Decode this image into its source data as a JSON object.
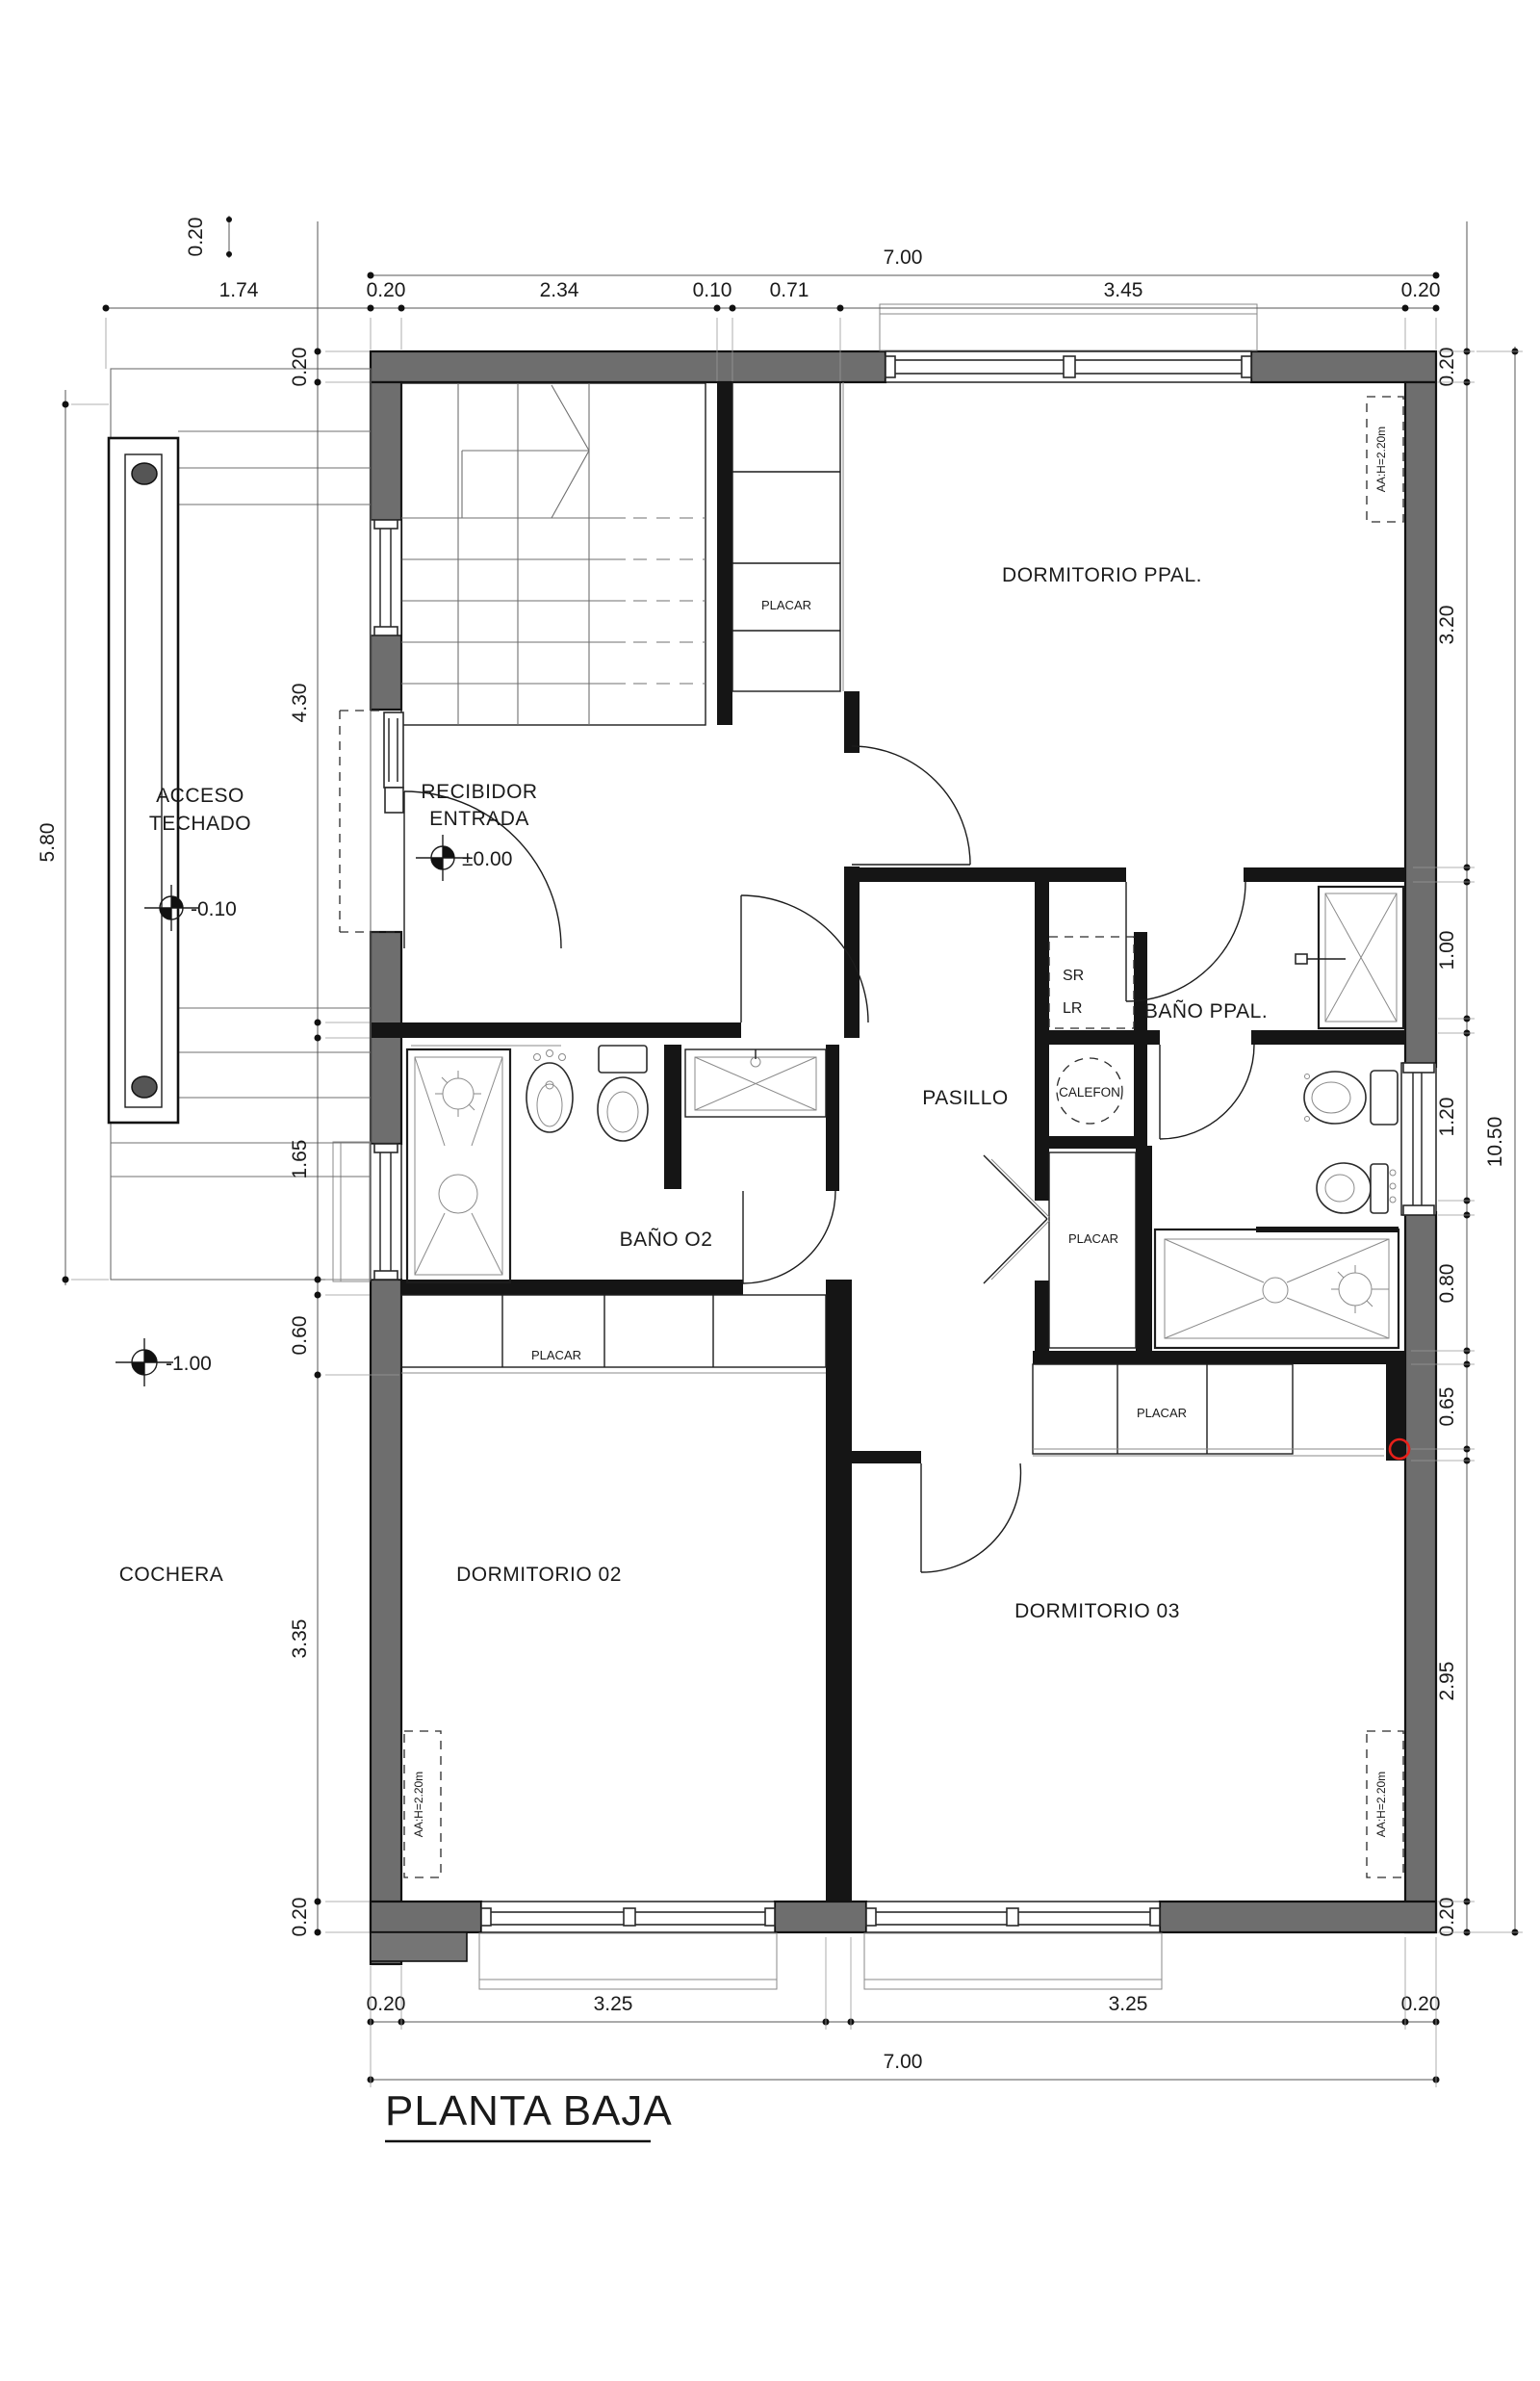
{
  "title": {
    "text": "PLANTA BAJA"
  },
  "rooms": {
    "acceso": {
      "line1": "ACCESO",
      "line2": "TECHADO",
      "level": "-0.10"
    },
    "recibidor": {
      "line1": "RECIBIDOR",
      "line2": "ENTRADA",
      "level": "±0.00"
    },
    "dormitorio_ppal": {
      "label": "DORMITORIO PPAL."
    },
    "bano_ppal": {
      "label": "BAÑO PPAL."
    },
    "pasillo": {
      "label": "PASILLO"
    },
    "bano_02": {
      "label": "BAÑO O2"
    },
    "cochera": {
      "label": "COCHERA",
      "level": "-1.00"
    },
    "dormitorio_02": {
      "label": "DORMITORIO 02"
    },
    "dormitorio_03": {
      "label": "DORMITORIO 03"
    },
    "sr_lr": {
      "line1": "SR",
      "line2": "LR"
    },
    "calefon": {
      "label": "CALEFON"
    }
  },
  "closets": {
    "hall": "PLACAR",
    "dorm02": "PLACAR",
    "pasillo": "PLACAR",
    "dorm03": "PLACAR"
  },
  "ac": {
    "dorm_ppal": "AA:H=2.20m",
    "dorm02": "AA:H=2.20m",
    "dorm03": "AA:H=2.20m"
  },
  "dims": {
    "top": {
      "overall": "7.00",
      "chain": [
        "1.74",
        "0.20",
        "2.34",
        "0.10",
        "0.71",
        "3.45",
        "0.20"
      ]
    },
    "bottom": {
      "overall": "7.00",
      "chain": [
        "0.20",
        "3.25",
        "3.25",
        "0.20"
      ]
    },
    "left": {
      "outer": "5.80",
      "top_corner": "0.20",
      "chain": [
        "0.20",
        "4.30",
        "1.65",
        "0.60",
        "3.35",
        "0.20"
      ]
    },
    "right": {
      "overall": "10.50",
      "chain": [
        "0.20",
        "3.20",
        "1.00",
        "1.20",
        "0.80",
        "0.65",
        "2.95",
        "0.20"
      ]
    }
  },
  "colors": {
    "wall_fill": "#6e6e6e",
    "line": "#1c1c1c",
    "annotation": "#e8201a",
    "background": "#ffffff"
  }
}
